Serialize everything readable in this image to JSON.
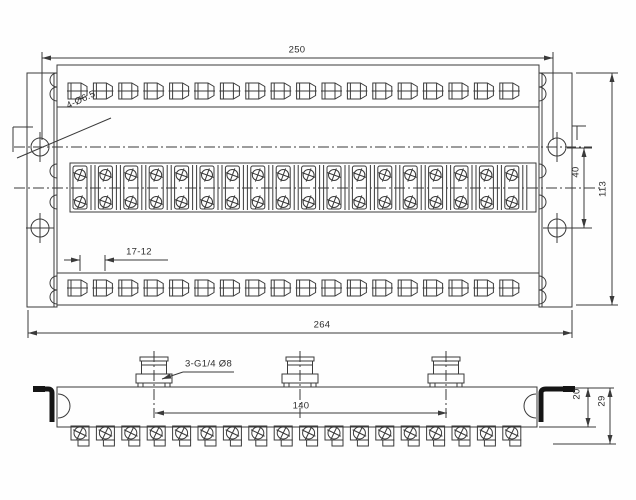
{
  "drawing": {
    "background": "#fefefe",
    "line_color": "#3a3a3a",
    "top_view": {
      "dimensions": {
        "hole_span_width": "250",
        "overall_width": "264",
        "overall_height": "113",
        "hole_vertical_spacing": "40",
        "port_pitch": "17-12"
      },
      "labels": {
        "corner_holes": "4-Ø6.5"
      },
      "counts": {
        "top_row_ports": 18,
        "bottom_row_ports": 18,
        "terminals": 18,
        "scallop_rows": 6
      }
    },
    "front_view": {
      "dimensions": {
        "inlet_span": "140",
        "body_height": "20",
        "overall_height": "29"
      },
      "labels": {
        "inlets": "3-G1/4 Ø8"
      },
      "counts": {
        "inlets": 3,
        "bottom_ports": 18
      }
    }
  }
}
